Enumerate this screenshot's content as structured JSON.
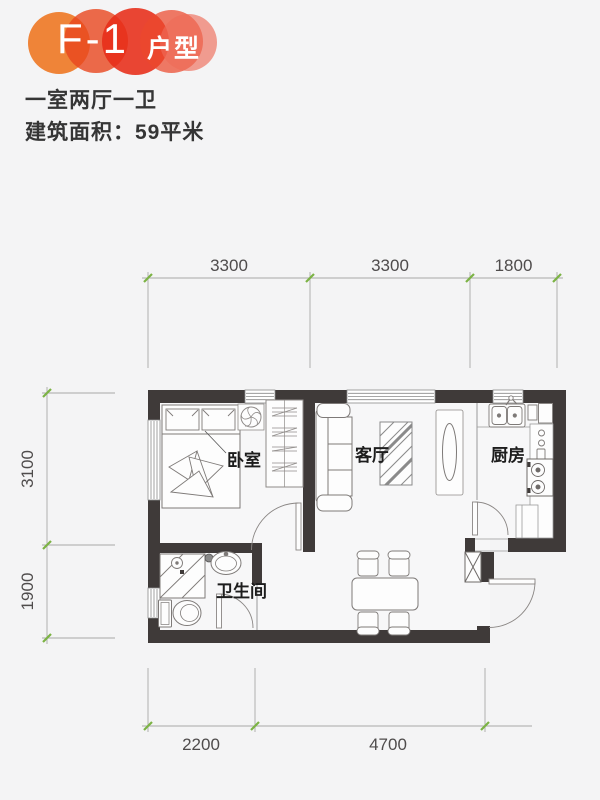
{
  "logo": {
    "code": "F-1",
    "suffix": "户型"
  },
  "header": {
    "layout_type": "一室两厅一卫",
    "area": "建筑面积：59平米"
  },
  "plan": {
    "room_labels": {
      "bedroom": "卧室",
      "living": "客厅",
      "kitchen": "厨房",
      "bathroom": "卫生间"
    },
    "dimensions": {
      "top": [
        "3300",
        "3300",
        "1800"
      ],
      "left": [
        "3100",
        "1900"
      ],
      "bottom": [
        "2200",
        "4700"
      ]
    }
  },
  "colors": {
    "wall": "#3f3a39",
    "dim_tick": "#7cb344",
    "logo_orange": "#ee7d2d",
    "logo_red": "#e73a21"
  }
}
